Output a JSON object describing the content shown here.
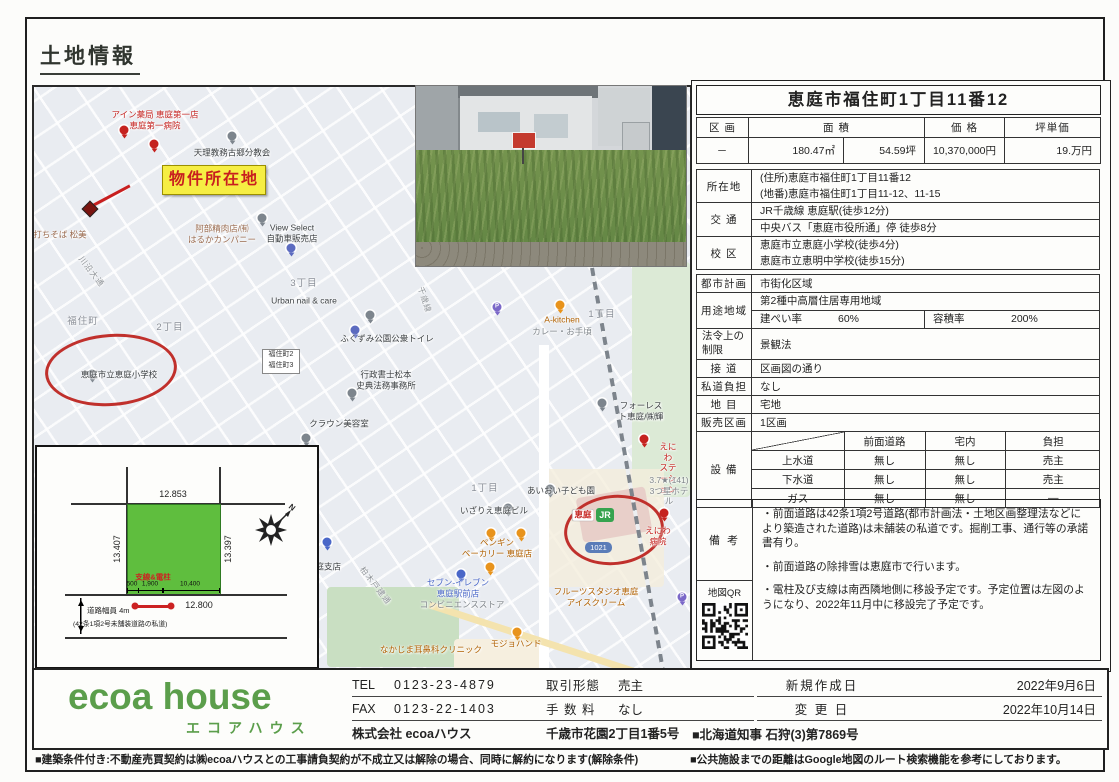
{
  "page": {
    "heading": "土地情報",
    "notes": {
      "left": "■建築条件付き:不動産売買契約は㈱ecoaハウスとの工事請負契約が不成立又は解除の場合、同時に解約になります(解除条件)",
      "right": "■公共施設までの距離はGoogle地図のルート検索機能を参考にしております。"
    }
  },
  "colors": {
    "accent_red": "#c0302c",
    "highlight_yellow": "#f6ee43",
    "parcel_green": "#5fbe3e",
    "logo_green": "#5b9e4b",
    "map_bg": "#e9ecf1"
  },
  "map": {
    "property_label": "物件所在地",
    "jr_badge": "JR",
    "route_shield": "1021",
    "bus_stop": {
      "line1": "福住町2",
      "line2": "福住町3"
    },
    "labels": [
      {
        "text": "アイン薬局 恵庭第一店\n恵庭第一病院",
        "cls": "ml-red",
        "x": 121,
        "y": 33
      },
      {
        "text": "天理教務古郷分教会",
        "cls": "ml-dark",
        "x": 198,
        "y": 66
      },
      {
        "text": "打ちそば 松美",
        "cls": "ml-brown",
        "x": 26,
        "y": 148
      },
      {
        "text": "阿部精肉店/㈲\nはるかカンパニー",
        "cls": "ml-brown",
        "x": 188,
        "y": 147
      },
      {
        "text": "View Select\n自動車販売店",
        "cls": "ml-dark",
        "x": 258,
        "y": 146
      },
      {
        "text": "3丁目",
        "cls": "ml-area",
        "x": 270,
        "y": 197
      },
      {
        "text": "川沿大通",
        "cls": "ml-road",
        "x": 57,
        "y": 185,
        "rot": 52
      },
      {
        "text": "福住町",
        "cls": "ml-area",
        "x": 49,
        "y": 235
      },
      {
        "text": "2丁目",
        "cls": "ml-area",
        "x": 136,
        "y": 241
      },
      {
        "text": "Urban nail & care",
        "cls": "ml-dark",
        "x": 270,
        "y": 214
      },
      {
        "text": "ふくずみ公園公衆トイレ",
        "cls": "ml-dark",
        "x": 353,
        "y": 252
      },
      {
        "text": "恵庭市立恵庭小学校",
        "cls": "ml-dark",
        "x": 85,
        "y": 288
      },
      {
        "text": "行政書士松本\n史典法務事務所",
        "cls": "ml-dark",
        "x": 352,
        "y": 293
      },
      {
        "text": "クラウン美容室",
        "cls": "ml-dark",
        "x": 305,
        "y": 337
      },
      {
        "text": "千歳線",
        "cls": "ml-road",
        "x": 390,
        "y": 213,
        "rot": 72
      },
      {
        "text": "A-kitchen",
        "cls": "ml-orange",
        "x": 528,
        "y": 233
      },
      {
        "text": "カレー・お手頃",
        "cls": "ml-gray",
        "x": 528,
        "y": 245
      },
      {
        "text": "1丁目",
        "cls": "ml-area",
        "x": 568,
        "y": 228
      },
      {
        "text": "フォーレスト恵庭/㈱輝",
        "cls": "ml-dark",
        "x": 607,
        "y": 324
      },
      {
        "text": "えにわ\nステーション",
        "cls": "ml-red",
        "x": 634,
        "y": 381
      },
      {
        "text": "3.7★(141)\n3つ星ホテル",
        "cls": "ml-gray",
        "x": 635,
        "y": 404
      },
      {
        "text": "あいおい子ども園",
        "cls": "ml-dark",
        "x": 527,
        "y": 404
      },
      {
        "text": "1丁目",
        "cls": "ml-area",
        "x": 451,
        "y": 402
      },
      {
        "text": "いざりえ恵庭ビル",
        "cls": "ml-dark",
        "x": 460,
        "y": 424
      },
      {
        "text": "恵庭",
        "cls": "ml-red ml-chip",
        "x": 549,
        "y": 428
      },
      {
        "text": "えにわ病院",
        "cls": "ml-red",
        "x": 624,
        "y": 449
      },
      {
        "text": "ペンギン\nベーカリー 恵庭店",
        "cls": "ml-orange",
        "x": 463,
        "y": 461
      },
      {
        "text": "セブン-イレブン\n恵庭駅前店",
        "cls": "ml-blue",
        "x": 424,
        "y": 501
      },
      {
        "text": "コンビニエンスストア",
        "cls": "ml-gray",
        "x": 428,
        "y": 518
      },
      {
        "text": "フルーツスタジオ恵庭\nアイスクリーム",
        "cls": "ml-orange",
        "x": 562,
        "y": 510
      },
      {
        "text": "モジョハンド",
        "cls": "ml-orange",
        "x": 482,
        "y": 557
      },
      {
        "text": "なかじま耳鼻科クリニック",
        "cls": "ml-orange",
        "x": 397,
        "y": 563
      },
      {
        "text": "恵庭支店",
        "cls": "ml-dark",
        "x": 290,
        "y": 480
      },
      {
        "text": "柏木戸建通",
        "cls": "ml-road",
        "x": 341,
        "y": 499,
        "rot": 52
      }
    ],
    "pins": [
      {
        "x": 90,
        "y": 43,
        "c": "#c5221f"
      },
      {
        "x": 120,
        "y": 57,
        "c": "#c5221f"
      },
      {
        "x": 198,
        "y": 49,
        "c": "#7d858d"
      },
      {
        "x": 228,
        "y": 131,
        "c": "#7d858d"
      },
      {
        "x": 257,
        "y": 161,
        "c": "#5c6bc0"
      },
      {
        "x": 336,
        "y": 228,
        "c": "#7d858d"
      },
      {
        "x": 321,
        "y": 243,
        "c": "#5c6bc0"
      },
      {
        "x": 58,
        "y": 287,
        "c": "#7d858d"
      },
      {
        "x": 318,
        "y": 306,
        "c": "#7d858d"
      },
      {
        "x": 272,
        "y": 351,
        "c": "#7d858d"
      },
      {
        "x": 463,
        "y": 220,
        "c": "#7b68c8",
        "t": "P"
      },
      {
        "x": 526,
        "y": 218,
        "c": "#e8931c"
      },
      {
        "x": 568,
        "y": 316,
        "c": "#7d858d"
      },
      {
        "x": 610,
        "y": 352,
        "c": "#c5221f"
      },
      {
        "x": 516,
        "y": 402,
        "c": "#7d858d"
      },
      {
        "x": 474,
        "y": 421,
        "c": "#7d858d"
      },
      {
        "x": 630,
        "y": 426,
        "c": "#c5221f"
      },
      {
        "x": 487,
        "y": 446,
        "c": "#e8931c"
      },
      {
        "x": 457,
        "y": 446,
        "c": "#e8931c"
      },
      {
        "x": 456,
        "y": 480,
        "c": "#e8931c"
      },
      {
        "x": 427,
        "y": 487,
        "c": "#4a67c8"
      },
      {
        "x": 483,
        "y": 545,
        "c": "#e8931c"
      },
      {
        "x": 293,
        "y": 455,
        "c": "#4a67c8"
      },
      {
        "x": 648,
        "y": 510,
        "c": "#7b68c8",
        "t": "P"
      }
    ]
  },
  "site_plan": {
    "dim_top": "12.853",
    "dim_left": "13.407",
    "dim_right": "13.397",
    "dim_bottom": "12.800",
    "seg_1": "500",
    "seg_2": "1,900",
    "seg_3": "10,400",
    "pole_label": "支線&電柱",
    "road_width": "道路幅員 4m",
    "road_note": "(42条1項2号未舗装道路の私道)",
    "compass": "N"
  },
  "panel": {
    "title": "恵庭市福住町1丁目11番12",
    "summary": {
      "col_lot": "区 画",
      "col_area": "面 積",
      "col_price": "価 格",
      "col_unit": "坪単価",
      "lot": "－",
      "area_m2": "180.47㎡",
      "area_tsubo": "54.59坪",
      "price": "10,370,000円",
      "unit_price": "19.万円"
    },
    "location": {
      "label": "所在地",
      "line1": "(住所)恵庭市福住町1丁目11番12",
      "line2": "(地番)恵庭市福住町1丁目11-12、11-15"
    },
    "transport": {
      "label": "交 通",
      "line1": "JR千歳線 恵庭駅(徒歩12分)",
      "line2": "中央バス「恵庭市役所通」停 徒歩8分"
    },
    "school": {
      "label": "校 区",
      "line1": "恵庭市立恵庭小学校(徒歩4分)",
      "line2": "恵庭市立恵明中学校(徒歩15分)"
    },
    "city_plan": {
      "label": "都市計画",
      "value": "市街化区域"
    },
    "zoning": {
      "label": "用途地域",
      "value": "第2種中高層住居専用地域",
      "bcr_label": "建ぺい率",
      "bcr": "60%",
      "far_label": "容積率",
      "far": "200%"
    },
    "legal": {
      "label": "法令上の\n制限",
      "value": "景観法"
    },
    "road": {
      "label": "接 道",
      "value": "区画図の通り"
    },
    "private_road": {
      "label": "私道負担",
      "value": "なし"
    },
    "land_cat": {
      "label": "地 目",
      "value": "宅地"
    },
    "lots": {
      "label": "販売区画",
      "value": "1区画"
    },
    "equipment": {
      "label": "設 備",
      "col1": "前面道路",
      "col2": "宅内",
      "col3": "負担",
      "rows": [
        {
          "name": "上水道",
          "v1": "無し",
          "v2": "無し",
          "v3": "売主"
        },
        {
          "name": "下水道",
          "v1": "無し",
          "v2": "無し",
          "v3": "売主"
        },
        {
          "name": "ガス",
          "v1": "無し",
          "v2": "無し",
          "v3": "—"
        }
      ]
    },
    "remarks": {
      "label": "備 考",
      "qr_label": "地図QR",
      "bullet1": "・前面道路は42条1項2号道路(都市計画法・土地区画整理法などにより築造された道路)は未舗装の私道です。掘削工事、通行等の承諾書有り。",
      "bullet2": "・前面道路の除排雪は恵庭市で行います。",
      "bullet3": "・電柱及び支線は南西隣地側に移設予定です。予定位置は左図のようになり、2022年11月中に移設完了予定です。"
    }
  },
  "footer": {
    "logo": "ecoa house",
    "logo_kana": "エコアハウス",
    "tel_label": "TEL",
    "tel": "0123-23-4879",
    "fax_label": "FAX",
    "fax": "0123-22-1403",
    "company": "株式会社 ecoaハウス",
    "address": "千歳市花園2丁目1番5号",
    "deal_label": "取引形態",
    "deal": "売主",
    "fee_label": "手 数 料",
    "fee": "なし",
    "created_label": "新規作成日",
    "created": "2022年9月6日",
    "updated_label": "変 更 日",
    "updated": "2022年10月14日",
    "license": "■北海道知事 石狩(3)第7869号"
  }
}
